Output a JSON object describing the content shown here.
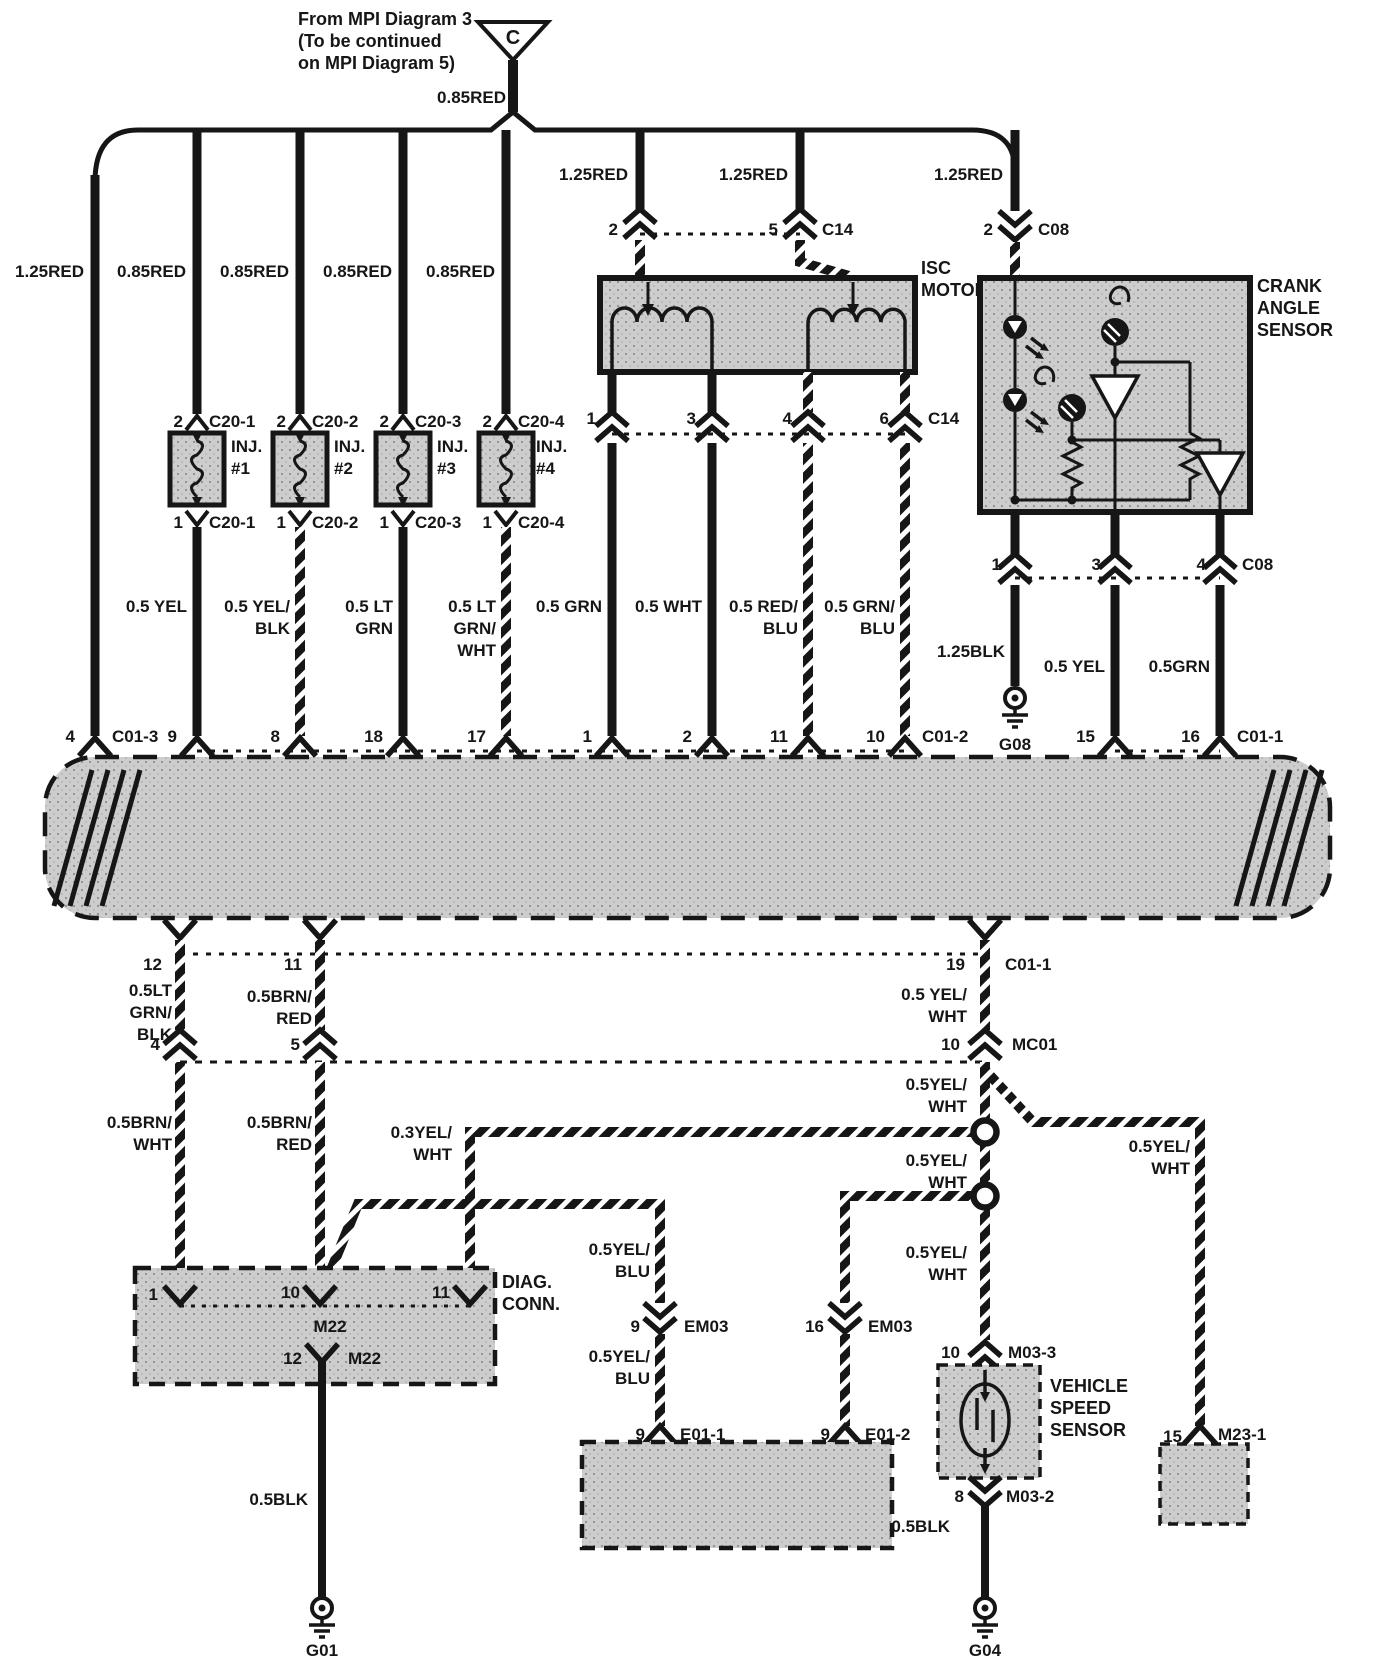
{
  "meta": {
    "ink": "#161616",
    "box_fill": "#cdcdcd",
    "background": "#ffffff"
  },
  "header": {
    "note_line1": "From MPI Diagram 3",
    "note_line2": "(To be continued",
    "note_line3": "on MPI Diagram 5)",
    "connector_letter": "C",
    "feed_wire": "0.85RED"
  },
  "top_feeds": {
    "w1": "1.25RED",
    "w2": "0.85RED",
    "w3": "0.85RED",
    "w4": "0.85RED",
    "w5": "0.85RED",
    "isc_a": "1.25RED",
    "isc_b": "1.25RED",
    "crank": "1.25RED"
  },
  "isc": {
    "title_l1": "ISC",
    "title_l2": "MOTOR",
    "pin_a": "2",
    "pin_b": "5",
    "conn_top": "C14",
    "out1": "1",
    "out2": "3",
    "out3": "4",
    "out4": "6",
    "conn_out": "C14"
  },
  "crank": {
    "title_l1": "CRANK",
    "title_l2": "ANGLE",
    "title_l3": "SENSOR",
    "pin_top": "2",
    "conn_top": "C08",
    "out1": "1",
    "out2": "3",
    "out3": "4",
    "conn_out": "C08",
    "ground": "G08"
  },
  "injectors": [
    {
      "pin_top": "2",
      "conn_top": "C20-1",
      "name": "INJ.",
      "num": "#1",
      "pin_bot": "1",
      "conn_bot": "C20-1"
    },
    {
      "pin_top": "2",
      "conn_top": "C20-2",
      "name": "INJ.",
      "num": "#2",
      "pin_bot": "1",
      "conn_bot": "C20-2"
    },
    {
      "pin_top": "2",
      "conn_top": "C20-3",
      "name": "INJ.",
      "num": "#3",
      "pin_bot": "1",
      "conn_bot": "C20-3"
    },
    {
      "pin_top": "2",
      "conn_top": "C20-4",
      "name": "INJ.",
      "num": "#4",
      "pin_bot": "1",
      "conn_bot": "C20-4"
    }
  ],
  "mid_wires": {
    "m1": {
      "l1": "0.5 YEL"
    },
    "m2": {
      "l1": "0.5 YEL/",
      "l2": "BLK"
    },
    "m3": {
      "l1": "0.5 LT",
      "l2": "GRN"
    },
    "m4": {
      "l1": "0.5 LT",
      "l2": "GRN/",
      "l3": "WHT"
    },
    "m5": {
      "l1": "0.5 GRN"
    },
    "m6": {
      "l1": "0.5 WHT"
    },
    "m7": {
      "l1": "0.5 RED/",
      "l2": "BLU"
    },
    "m8": {
      "l1": "0.5 GRN/",
      "l2": "BLU"
    },
    "m9": {
      "l1": "1.25BLK"
    },
    "m10": {
      "l1": "0.5 YEL"
    },
    "m11": {
      "l1": "0.5GRN"
    }
  },
  "ecu_top": {
    "p_4": "4",
    "c_4": "C01-3",
    "p_9": "9",
    "p_8": "8",
    "p_18": "18",
    "p_17": "17",
    "p_1": "1",
    "p_2": "2",
    "p_11": "11",
    "p_10": "10",
    "c_10": "C01-2",
    "p_15": "15",
    "p_16": "16",
    "c_16": "C01-1"
  },
  "ecu_bottom": {
    "p_12": "12",
    "p_11": "11",
    "p_19": "19",
    "c_19": "C01-1",
    "w12": {
      "l1": "0.5LT",
      "l2": "GRN/",
      "l3": "BLK"
    },
    "w11": {
      "l1": "0.5BRN/",
      "l2": "RED"
    },
    "w19": {
      "l1": "0.5 YEL/",
      "l2": "WHT"
    },
    "row2": {
      "p4": "4",
      "p5": "5",
      "p10": "10",
      "conn": "MC01"
    }
  },
  "lower": {
    "brn_wht": {
      "l1": "0.5BRN/",
      "l2": "WHT"
    },
    "brn_red": {
      "l1": "0.5BRN/",
      "l2": "RED"
    },
    "yel_wht_03": {
      "l1": "0.3YEL/",
      "l2": "WHT"
    },
    "yw_below_mc01": {
      "l1": "0.5YEL/",
      "l2": "WHT"
    },
    "yw_mid": {
      "l1": "0.5YEL/",
      "l2": "WHT"
    },
    "yw_branch": {
      "l1": "0.5YEL/",
      "l2": "WHT"
    },
    "yw_below_splice": {
      "l1": "0.5YEL/",
      "l2": "WHT"
    },
    "yb_above": {
      "l1": "0.5YEL/",
      "l2": "BLU"
    },
    "yb_below": {
      "l1": "0.5YEL/",
      "l2": "BLU"
    }
  },
  "diag_conn": {
    "title_l1": "DIAG.",
    "title_l2": "CONN.",
    "pin1": "1",
    "pin10": "10",
    "pin11": "11",
    "conn": "M22",
    "pin12": "12",
    "conn_bot": "M22",
    "wire_bot": "0.5BLK",
    "ground": "G01"
  },
  "em03": {
    "pin_l": "9",
    "conn_l": "EM03",
    "pin_r": "16",
    "conn_r": "EM03"
  },
  "e01": {
    "pin_l": "9",
    "conn_l": "E01-1",
    "pin_r": "9",
    "conn_r": "E01-2"
  },
  "vss": {
    "title_l1": "VEHICLE",
    "title_l2": "SPEED",
    "title_l3": "SENSOR",
    "pin_top": "10",
    "conn_top": "M03-3",
    "pin_bot": "8",
    "conn_bot": "M03-2",
    "wire_bot": "0.5BLK",
    "ground": "G04"
  },
  "m23": {
    "pin": "15",
    "conn": "M23-1"
  }
}
